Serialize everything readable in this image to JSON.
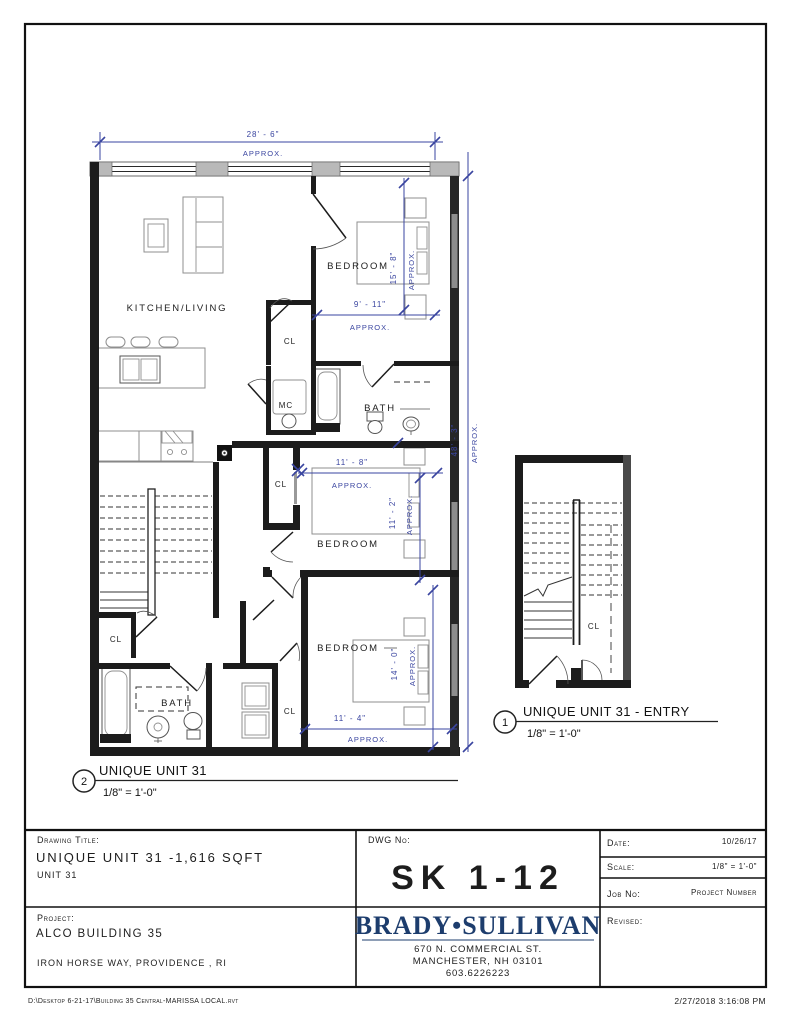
{
  "colors": {
    "dimension_blue": "#3a45a0",
    "brand_navy": "#1d3d6d",
    "wall_black": "#1c1c1c",
    "furniture_gray": "#8f8f8f",
    "pier_gray": "#b9b9b9"
  },
  "plan": {
    "rooms": {
      "kitchen_living": "KITCHEN/LIVING",
      "bedroom": "BEDROOM",
      "bath": "BATH",
      "closet": "CL",
      "mechanical": "MC"
    },
    "dimensions": {
      "approx": "APPROX.",
      "overall_width": "28' - 6\"",
      "overall_depth": "48' - 3\"",
      "bedroom1_width": "9' - 11\"",
      "bedroom1_depth": "15' - 8\"",
      "bedroom2_width": "11' - 8\"",
      "bedroom2_depth": "11' - 2\"",
      "bedroom3_depth": "14' - 0\"",
      "bedroom3_width": "11' - 4\""
    }
  },
  "views": {
    "entry": {
      "number": "1",
      "title": "UNIQUE UNIT 31 - ENTRY",
      "scale": "1/8\" = 1'-0\""
    },
    "unit": {
      "number": "2",
      "title": "UNIQUE UNIT 31",
      "scale": "1/8\" = 1'-0\""
    }
  },
  "title_block": {
    "drawing_title_label": "Drawing Title:",
    "drawing_title": "UNIQUE UNIT 31 -1,616 SQFT",
    "drawing_subtitle": "UNIT 31",
    "project_label": "Project:",
    "project_name": "ALCO BUILDING 35",
    "project_address": "IRON HORSE WAY, PROVIDENCE , RI",
    "dwg_no_label": "DWG No:",
    "dwg_no": "SK 1-12",
    "company_name": "BRADY•SULLIVAN",
    "company_address_line1": "670 N. COMMERCIAL ST.",
    "company_address_line2": "MANCHESTER, NH 03101",
    "company_phone": "603.6226223",
    "date_label": "Date:",
    "date_value": "10/26/17",
    "scale_label": "Scale:",
    "scale_value": "1/8\" = 1'-0\"",
    "job_label": "Job No:",
    "job_value": "Project Number",
    "revised_label": "Revised:"
  },
  "footer": {
    "file_path": "D:\\Desktop 6-21-17\\Building 35 Central-MARISSA LOCAL.rvt",
    "print_timestamp": "2/27/2018 3:16:08 PM"
  }
}
